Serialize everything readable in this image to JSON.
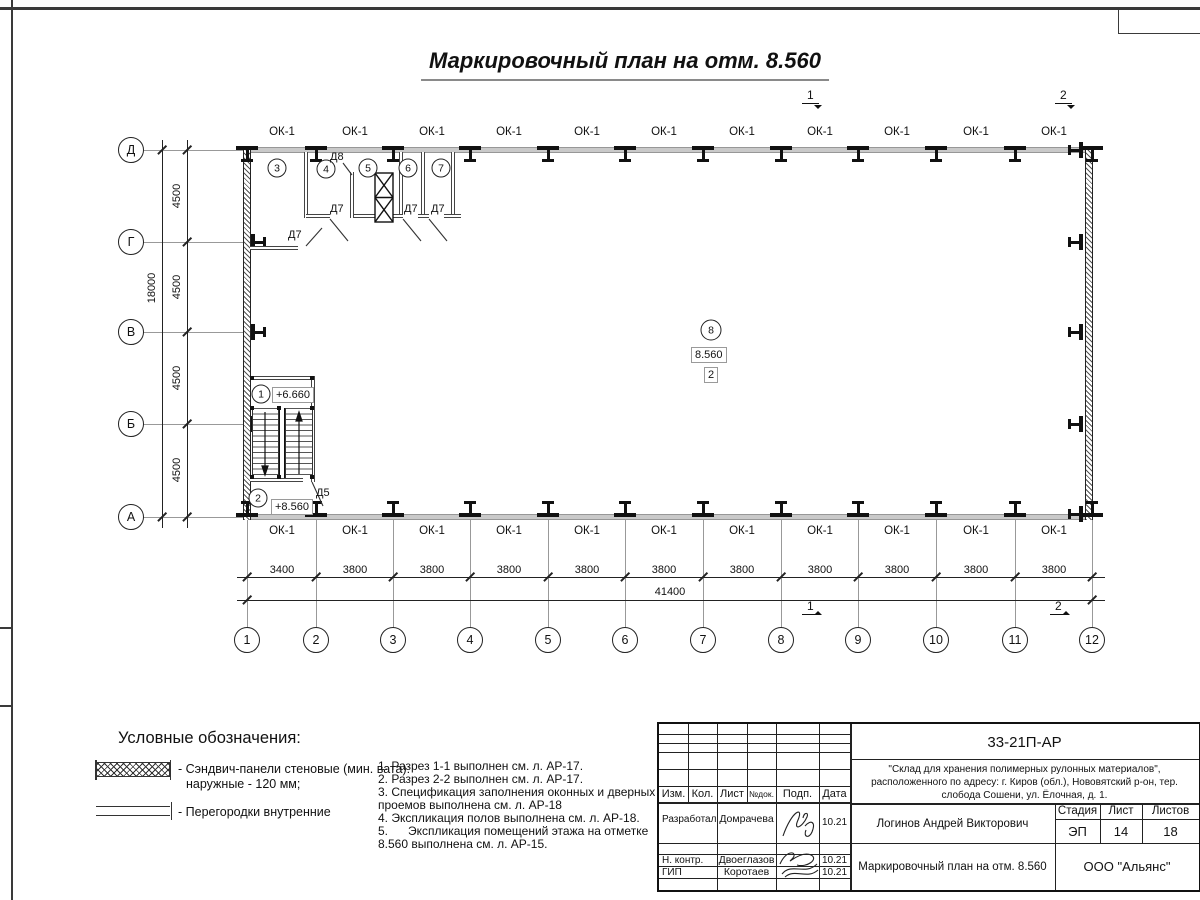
{
  "title": "Маркировочный план на отм. 8.560",
  "window_mark": "ОК-1",
  "axes_bottom": [
    "1",
    "2",
    "3",
    "4",
    "5",
    "6",
    "7",
    "8",
    "9",
    "10",
    "11",
    "12"
  ],
  "axes_left": [
    "Д",
    "Г",
    "В",
    "Б",
    "А"
  ],
  "dims": {
    "bottom": [
      "3400",
      "3800",
      "3800",
      "3800",
      "3800",
      "3800",
      "3800",
      "3800",
      "3800",
      "3800",
      "3800"
    ],
    "bottom_total": "41400",
    "left": [
      "4500",
      "4500",
      "4500",
      "4500"
    ],
    "left_total": "18000"
  },
  "rooms": {
    "r1": "1",
    "r2": "2",
    "r3": "3",
    "r4": "4",
    "r5": "5",
    "r6": "6",
    "r7": "7",
    "r8": "8"
  },
  "marks": {
    "elev1": "+6.660",
    "elev2": "+8.560",
    "elev8": "8.560",
    "sub8": "2"
  },
  "doors": {
    "d5": "Д5",
    "d7": "Д7",
    "d8": "Д8"
  },
  "sections": {
    "s1": "1",
    "s2": "2"
  },
  "legend": {
    "title": "Условные обозначения:",
    "item1_line1": "- Сэндвич-панели стеновые (мин. вата):",
    "item1_line2": "наружные - 120 мм;",
    "item2": "- Перегородки внутренние"
  },
  "notes": [
    "1. Разрез 1-1 выполнен см. л. АР-17.",
    "2. Разрез 2-2 выполнен см. л. АР-17.",
    "3. Спецификация заполнения оконных и дверных",
    "проемов выполнена см. л. АР-18",
    "4. Экспликация полов выполнена см. л. АР-18.",
    "5.      Экспликация помещений этажа на отметке",
    "8.560 выполнена см. л. АР-15."
  ],
  "stamp": {
    "doc_number": "33-21П-АР",
    "project_line1": "\"Склад для хранения полимерных рулонных материалов\",",
    "project_line2": "расположенного по адресу: г. Киров (обл.), Нововятский р-он, тер.",
    "project_line3": "слобода Сошени, ул. Ёлочная, д. 1.",
    "header": {
      "izm": "Изм.",
      "kol": "Кол.",
      "list": "Лист",
      "ndok": "№док.",
      "podp": "Подп.",
      "data": "Дата"
    },
    "rows": [
      {
        "role": "Разработал",
        "name": "Домрачева",
        "date": "10.21"
      },
      {
        "role": "Н. контр.",
        "name": "Двоеглазов",
        "date": "10.21"
      },
      {
        "role": "ГИП",
        "name": "Коротаев",
        "date": "10.21"
      }
    ],
    "chief": "Логинов Андрей Викторович",
    "sheet_title": "Маркировочный план на отм. 8.560",
    "stage_label": "Стадия",
    "sheet_label": "Лист",
    "sheets_label": "Листов",
    "stage": "ЭП",
    "sheet_no": "14",
    "sheets_total": "18",
    "company": "ООО \"Альянс\""
  }
}
